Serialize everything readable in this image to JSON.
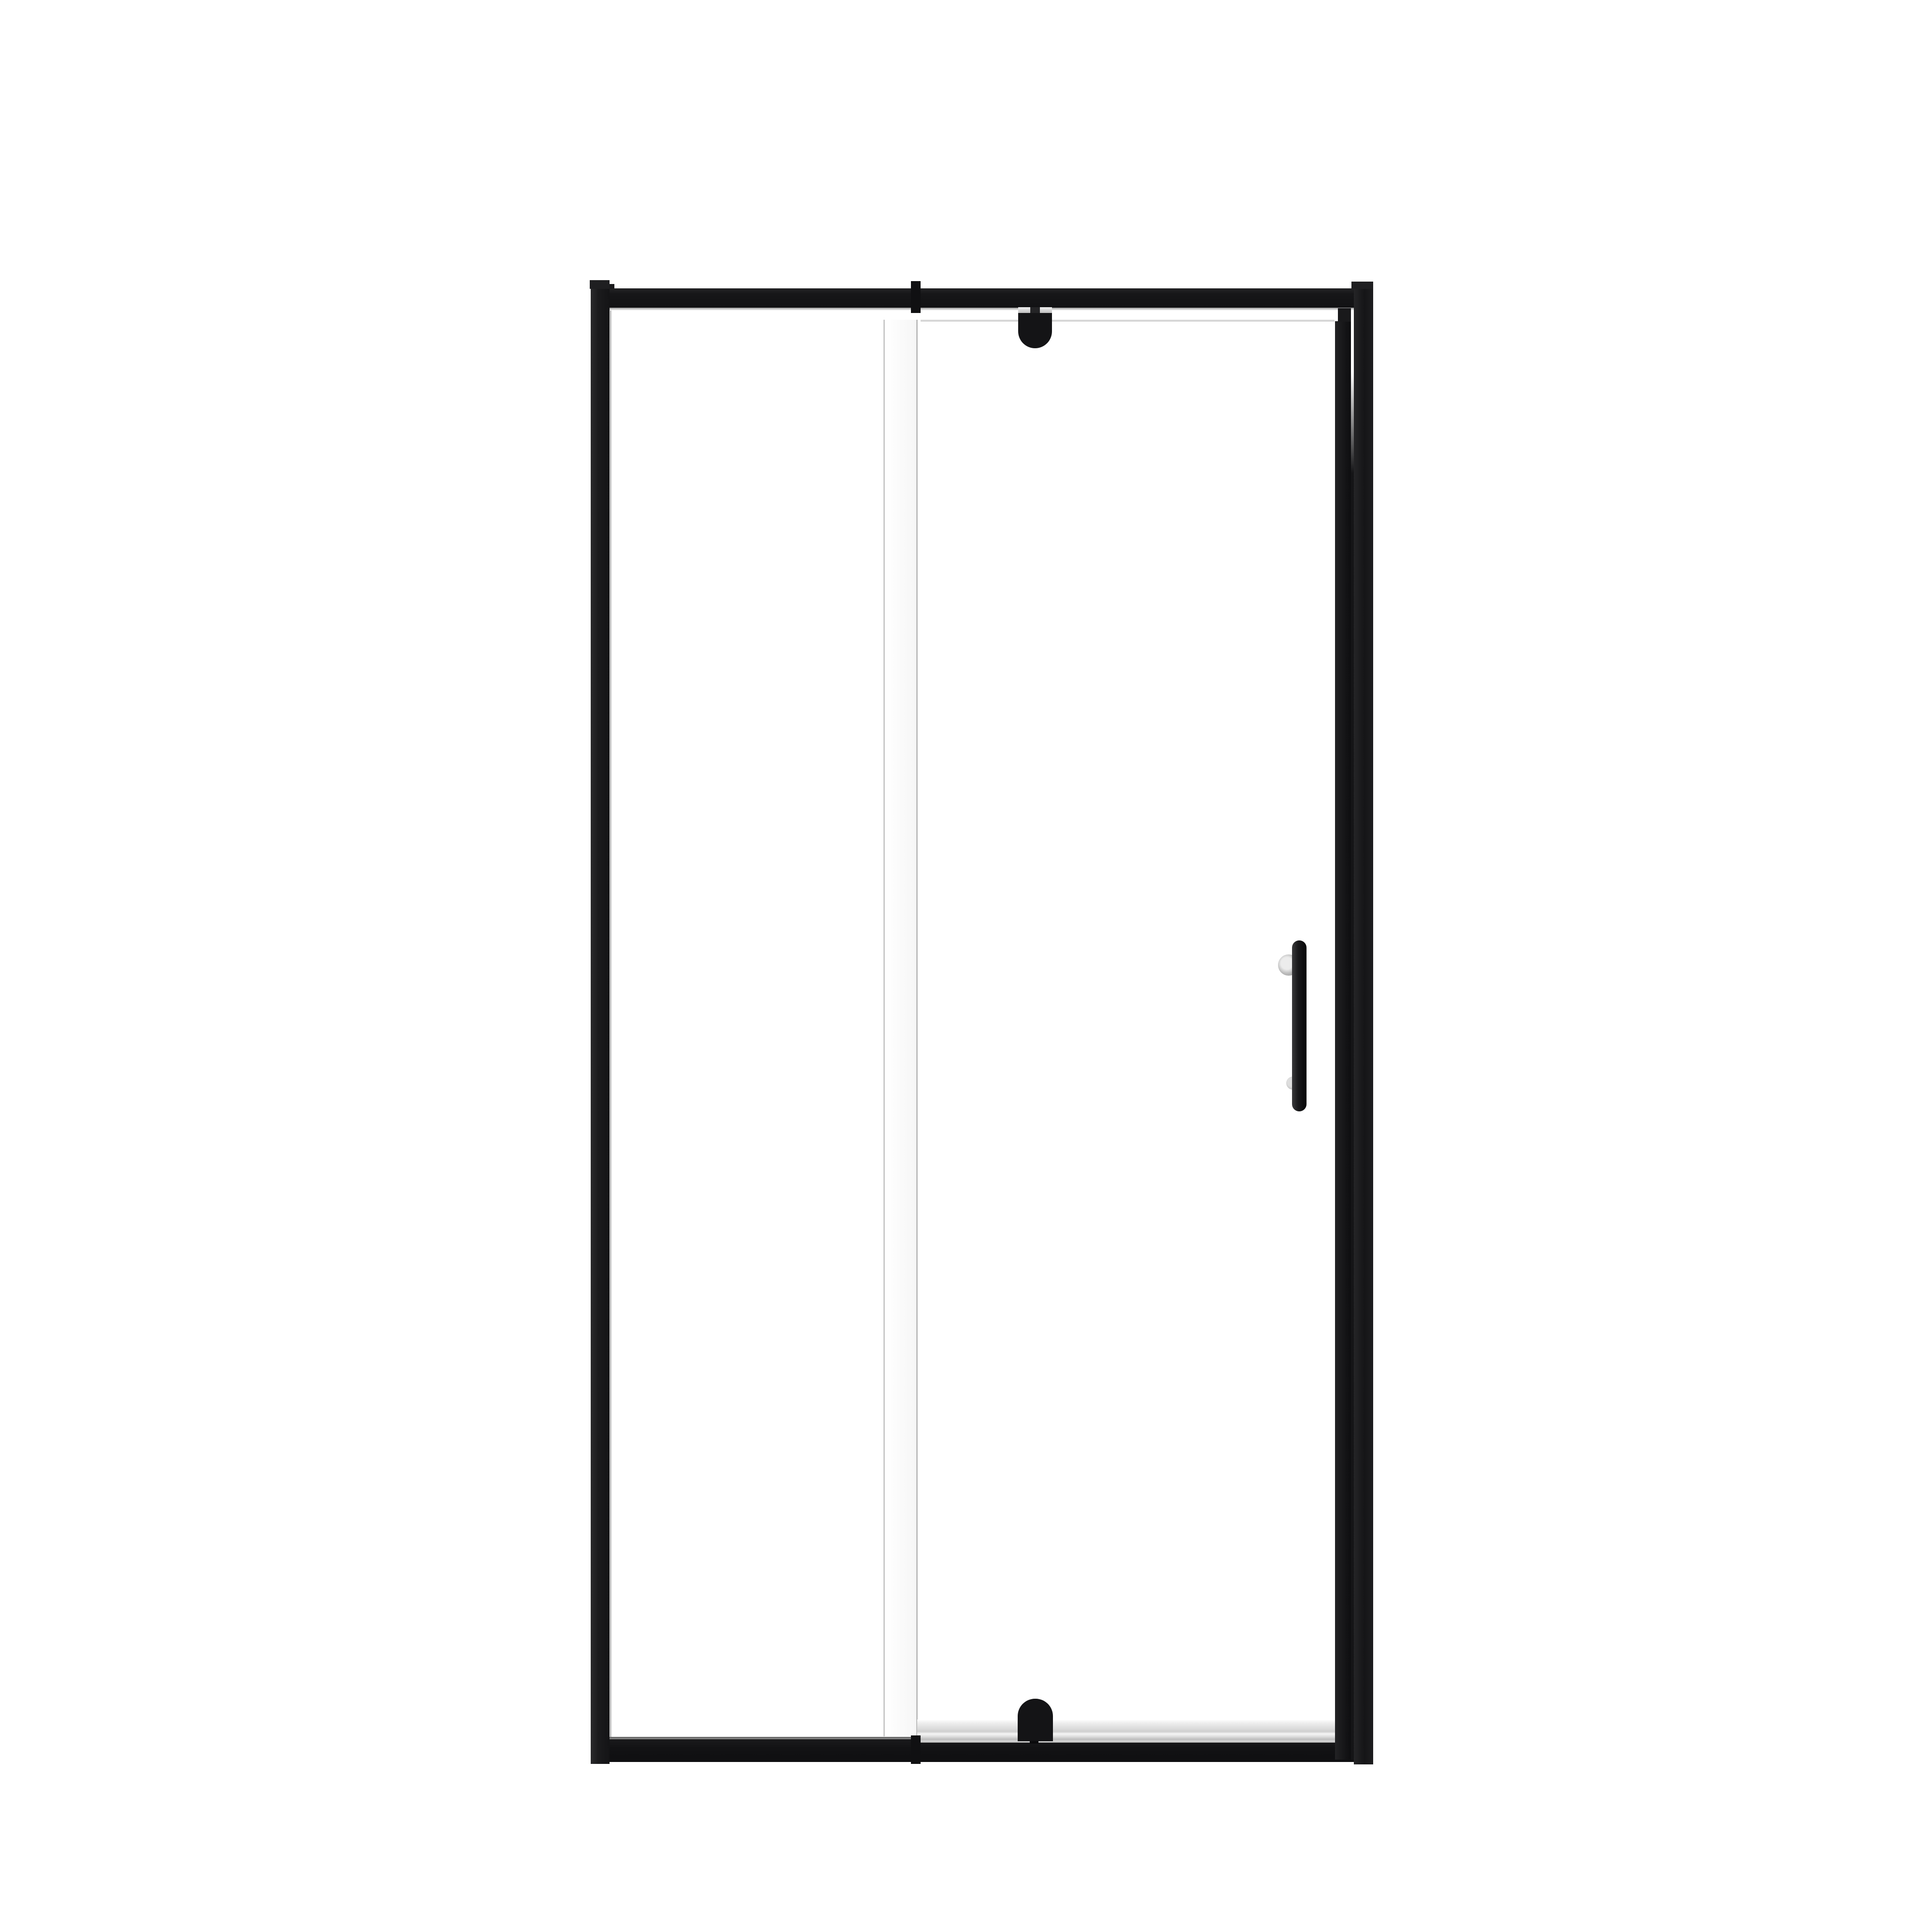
{
  "scene": {
    "description": "Pivot shower door product photo: black framed clear glass shower door on a plain white background",
    "background_color": "#ffffff"
  },
  "palette": {
    "frame_black": "#161618",
    "bracket_black": "#141416",
    "hardware_silver": "#c9c9c9",
    "sill_silver": "#d6d6d6",
    "glass_edge_gray": "#c9c9c9",
    "glass_white": "#fafafa"
  },
  "parts": {
    "left_wall_profile": "Left wall profile with top cap",
    "right_wall_profile": "Right wall profile with top cap",
    "header_rail": "Top header rail",
    "top_pivot": "Top pivot bracket with silver clamp",
    "fixed_panel_edge": "Fixed panel glass edge highlight strip",
    "door_glass": "Clear pivot door glass",
    "door_stile": "Door hinge-side black stile",
    "handle": "Vertical black pull handle on two silver standoffs",
    "threshold_sill": "Silver bottom threshold sill",
    "bottom_rail": "Bottom rail",
    "bottom_pivot": "Bottom pivot bracket"
  }
}
